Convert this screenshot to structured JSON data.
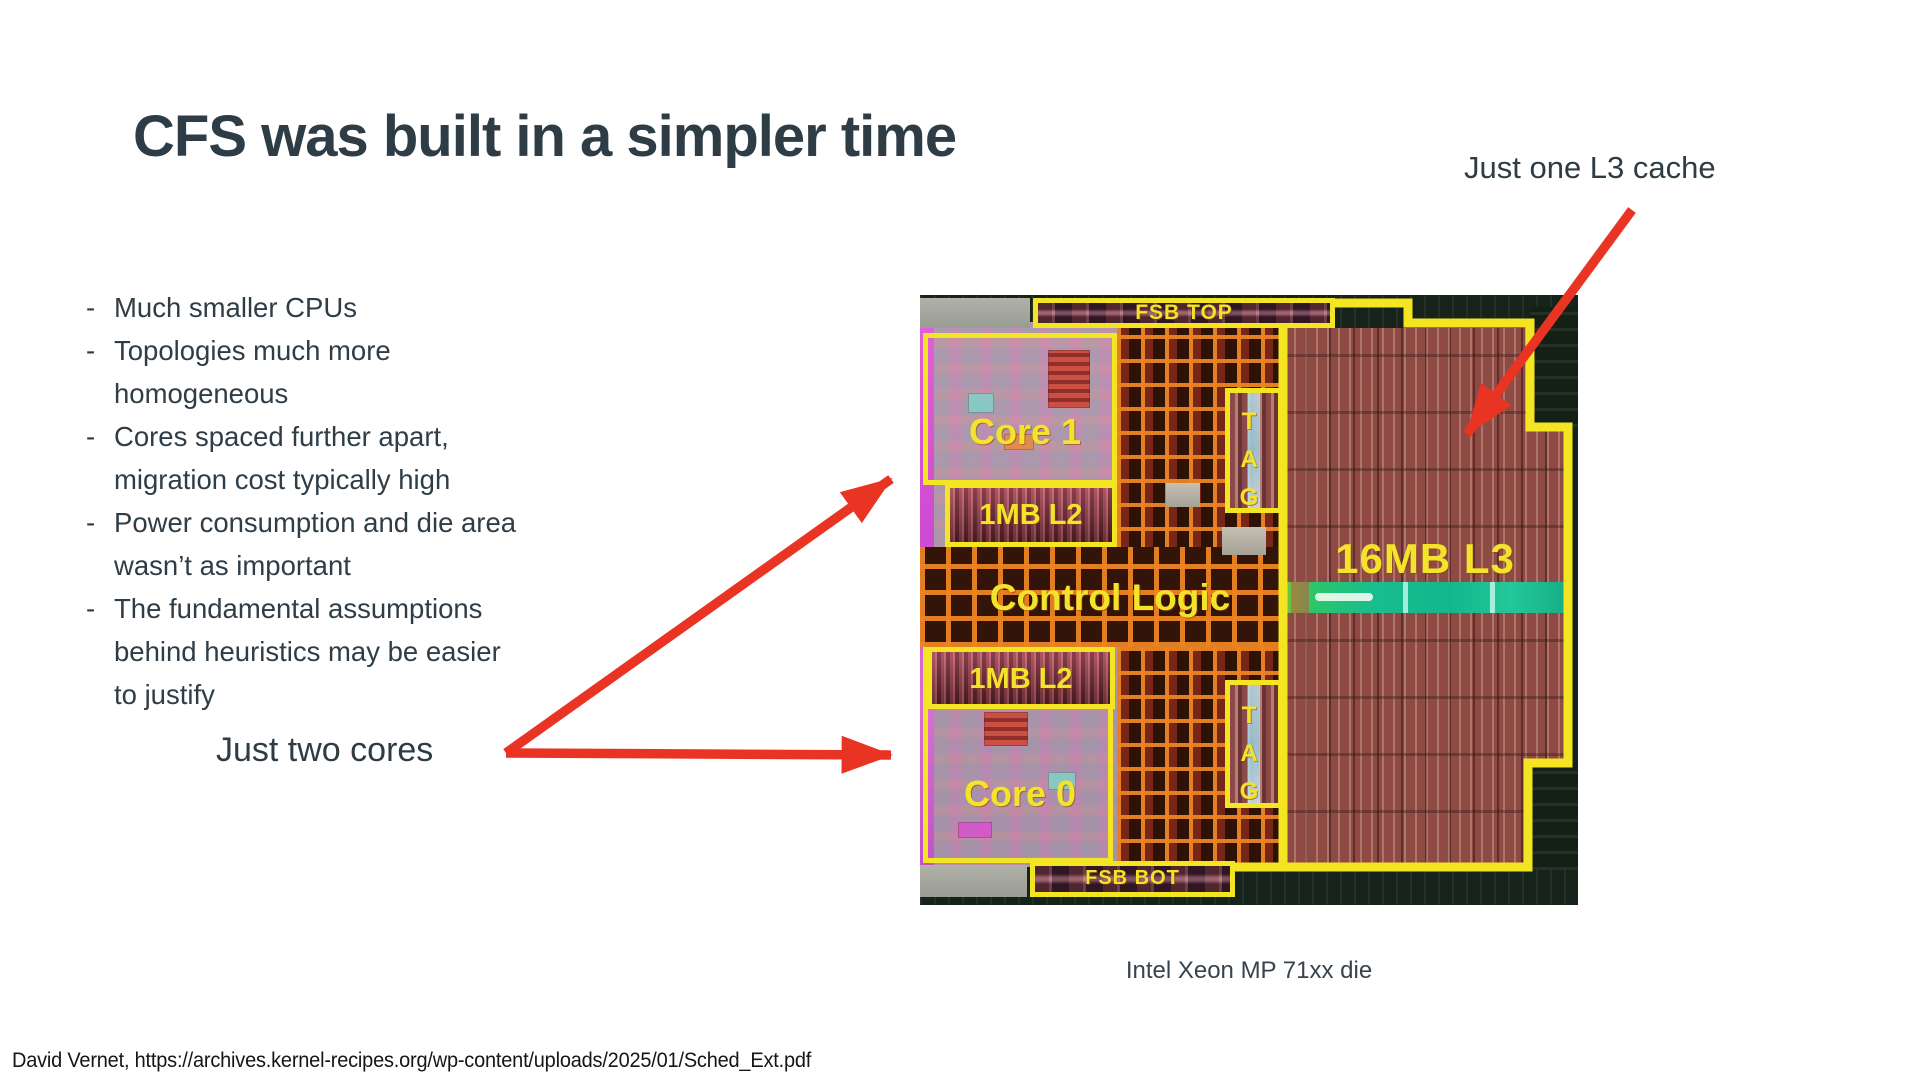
{
  "slide": {
    "title": "CFS was built in a simpler time",
    "bullets": [
      "Much smaller CPUs",
      "Topologies much more homogeneous",
      "Cores spaced further apart, migration cost typically high",
      "Power consumption and die area wasn’t as important",
      "The fundamental assumptions behind heuristics may be easier to justify"
    ],
    "annotations": {
      "l3": "Just one L3 cache",
      "cores": "Just two cores"
    },
    "die": {
      "labels": {
        "fsb_top": "FSB TOP",
        "core1": "Core 1",
        "l2_top": "1MB L2",
        "control_logic": "Control Logic",
        "l3": "16MB L3",
        "l2_bot": "1MB L2",
        "core0": "Core 0",
        "fsb_bot": "FSB BOT",
        "tag_top": "TAG",
        "tag_bot": "TAG"
      },
      "caption": "Intel Xeon MP 71xx die"
    },
    "footer": "David Vernet, https://archives.kernel-recipes.org/wp-content/uploads/2025/01/Sched_Ext.pdf",
    "colors": {
      "heading_text": "#2e3c45",
      "body_text": "#2f3d47",
      "arrow_red": "#ea3423",
      "die_outline_yellow": "#f4e522",
      "die_label_yellow": "#f3e32b",
      "l3_teal_stripe": "#18bd8e",
      "l3_array_maroon": "#8e4a43",
      "core_pink": "#bba7b8",
      "bus_orange": "#ec8424"
    }
  }
}
